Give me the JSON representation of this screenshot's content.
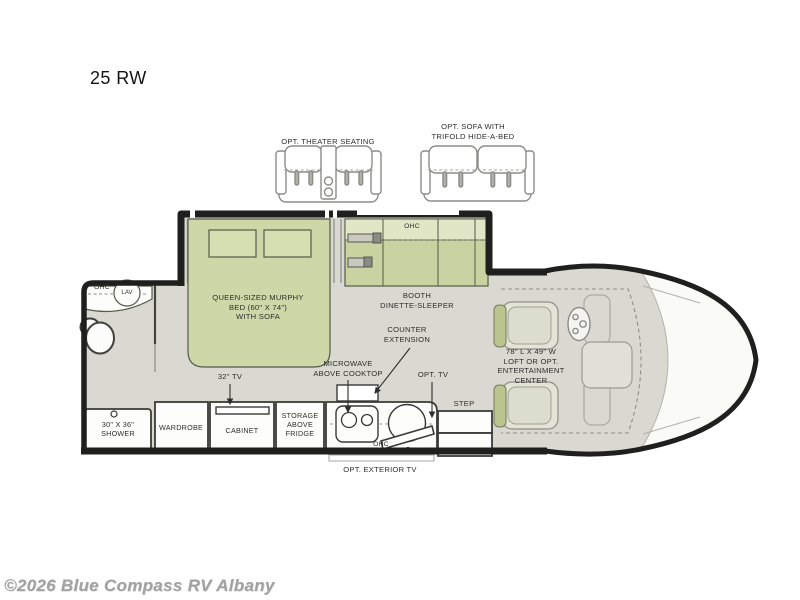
{
  "page": {
    "title": "25 RW",
    "watermark": "©2026 Blue Compass RV Albany"
  },
  "options": {
    "theater_label": "OPT. THEATER SEATING",
    "sofa_label": "OPT. SOFA WITH\nTRIFOLD HIDE-A-BED"
  },
  "floorplan": {
    "bed": "QUEEN-SIZED MURPHY\nBED (60\" X 74\")\nWITH SOFA",
    "booth": "BOOTH\nDINETTE-SLEEPER",
    "booth_ohc": "OHC",
    "bath_ohc": "OHC",
    "lav": "LAV",
    "shower": "30\" X 36\"\nSHOWER",
    "wardrobe": "WARDROBE",
    "cabinet": "CABINET",
    "tv32": "32\" TV",
    "storage": "STORAGE\nABOVE\nFRIDGE",
    "microwave": "MICROWAVE\nABOVE COOKTOP",
    "counter_ext": "COUNTER\nEXTENSION",
    "kitchen_ohc": "OHC",
    "opt_tv": "OPT. TV",
    "step": "STEP",
    "loft": "78\" L X 49\" W\nLOFT OR OPT.\nENTERTAINMENT\nCENTER",
    "exterior_tv": "OPT.  EXTERIOR TV"
  },
  "colors": {
    "furniture_green": "#c9d3a1",
    "ohc_band_green": "#e0e6c6",
    "floor_gray": "#d9d9d1",
    "wall_black": "#1f1f1d",
    "outline_gray": "#8c8c88",
    "label_ink": "#2e2e2c",
    "watermark_gray": "#a2a2a2"
  }
}
